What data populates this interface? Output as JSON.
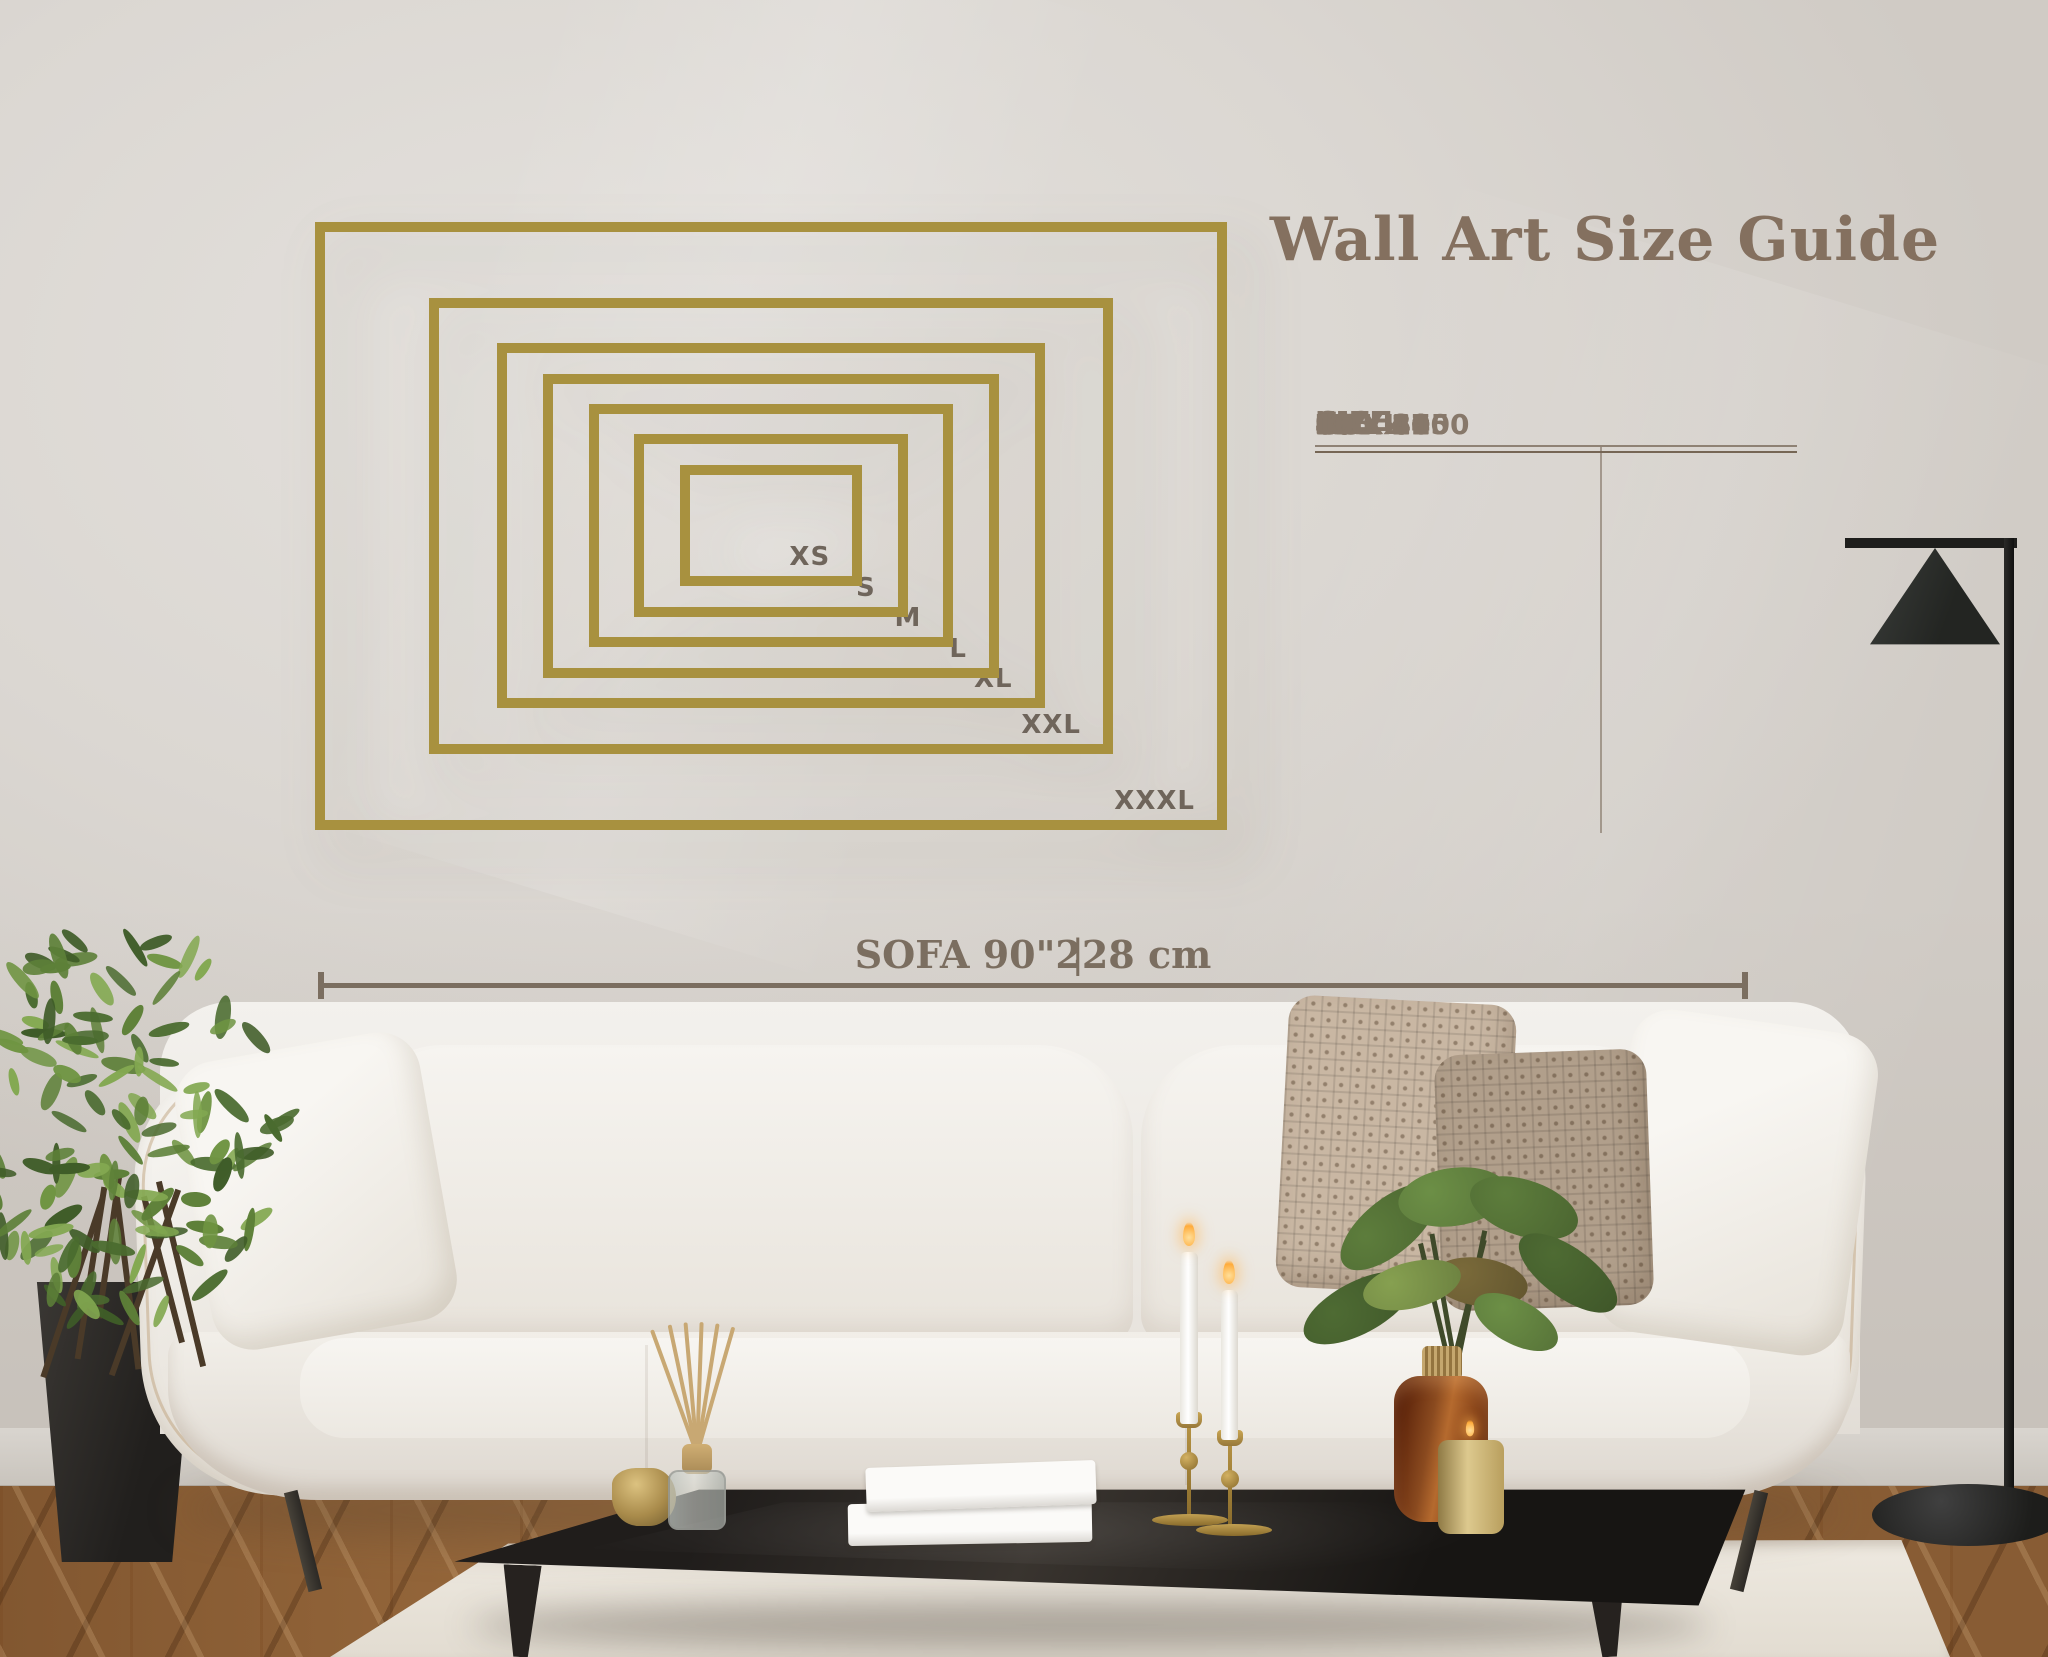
{
  "title": "Wall Art Size Guide",
  "table": {
    "headers": {
      "size": "SIZE",
      "inch": "INCH",
      "cm": "CM"
    },
    "rows": [
      {
        "size": "XS",
        "inch": "12 x 8",
        "cm": "30 x 20"
      },
      {
        "size": "S",
        "inch": "18 x 12",
        "cm": "46 x 30"
      },
      {
        "size": "M",
        "inch": "24 x 16",
        "cm": "60 x 40"
      },
      {
        "size": "L",
        "inch": "30 x 20",
        "cm": "76 x 51"
      },
      {
        "size": "XL",
        "inch": "36 x 24",
        "cm": "91 x 61"
      },
      {
        "size": "XXL",
        "inch": "45 x 30",
        "cm": "115 x 75"
      },
      {
        "size": "XXXL",
        "inch": "60 x 40",
        "cm": "150 x 100"
      }
    ]
  },
  "frames": [
    {
      "label": "XS",
      "w_in": 12,
      "h_in": 8
    },
    {
      "label": "S",
      "w_in": 18,
      "h_in": 12
    },
    {
      "label": "M",
      "w_in": 24,
      "h_in": 16
    },
    {
      "label": "L",
      "w_in": 30,
      "h_in": 20
    },
    {
      "label": "XL",
      "w_in": 36,
      "h_in": 24
    },
    {
      "label": "XXL",
      "w_in": 45,
      "h_in": 30
    },
    {
      "label": "XXXL",
      "w_in": 60,
      "h_in": 40
    }
  ],
  "sofa_measurement": {
    "label": "SOFA 90\"",
    "separator": "|",
    "value": "228 cm"
  },
  "colors": {
    "frame_gold": "#a8913f",
    "heading": "#84705f",
    "table_text": "#87786a",
    "frame_label": "#6f655b",
    "measure": "#7b6e60"
  }
}
